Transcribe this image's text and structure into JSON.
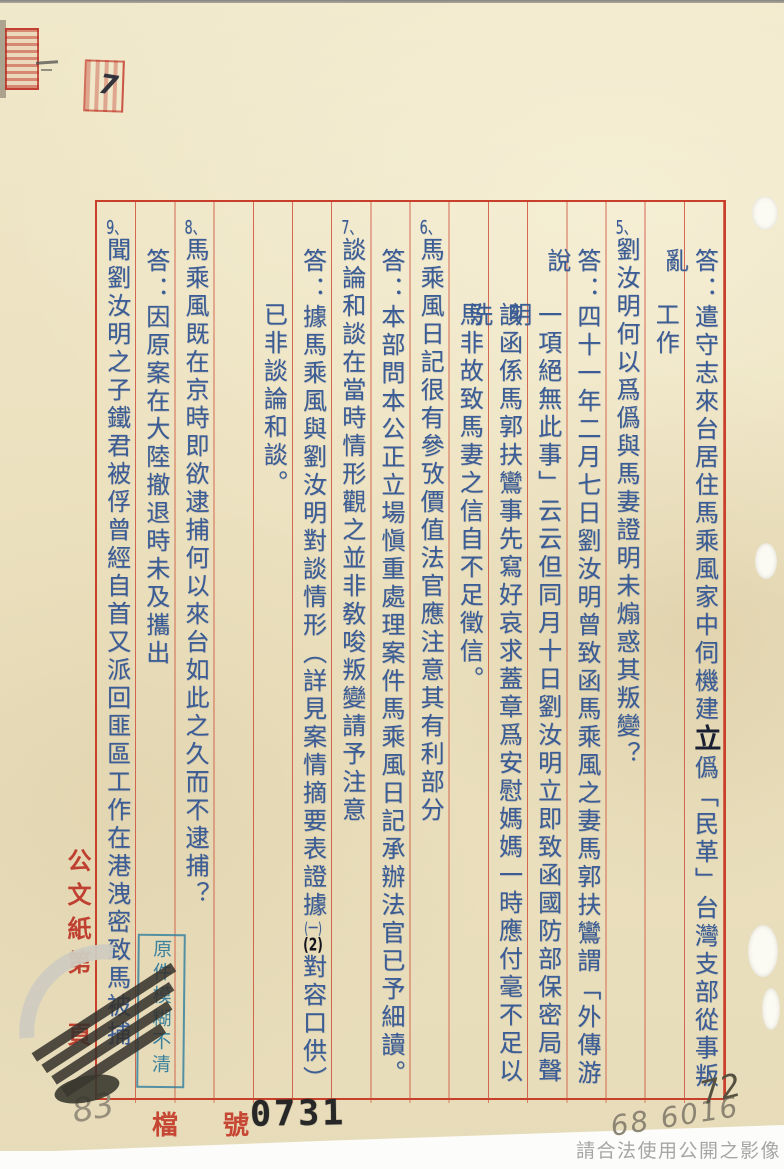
{
  "page": {
    "margin_label_top": "公文紙第",
    "margin_label_bottom": "頁",
    "file_label": "檔 號",
    "file_number": "0731",
    "handwritten_left": "83",
    "handwritten_right": "68 6016",
    "handwritten_ink": "72",
    "handwritten_mark": "7",
    "blue_stamp": "原件模糊不清",
    "usage_notice": "請合法使用公開之影像"
  },
  "colors": {
    "ink_blue": "#3b5c94",
    "frame_red": "#c8402c",
    "stamp_blue": "#2e7d9e",
    "seal_red": "#bb3a28"
  },
  "document": {
    "columns": [
      {
        "slot": 1,
        "indent": "answer",
        "segments": [
          {
            "t": "答：遣守志來台居住馬乘風家中伺機建",
            "k": "type"
          },
          {
            "t": "立",
            "k": "hand"
          },
          {
            "t": "僞「民革」台灣支部從事叛亂",
            "k": "type"
          }
        ]
      },
      {
        "slot": 2,
        "indent": "cont",
        "segments": [
          {
            "t": "工作",
            "k": "type"
          }
        ]
      },
      {
        "slot": 3,
        "indent": "item",
        "segments": [
          {
            "t": "5、",
            "k": "num"
          },
          {
            "t": "劉汝明何以爲僞與馬妻證明未煽惑其叛變？",
            "k": "type"
          }
        ]
      },
      {
        "slot": 4,
        "indent": "answer",
        "segments": [
          {
            "t": "答：四十一年二月七日劉汝明曾致函馬乘風之妻馬郭扶鸞謂「外傳游說",
            "k": "type"
          }
        ]
      },
      {
        "slot": 5,
        "indent": "cont",
        "segments": [
          {
            "t": "一項絕無此事」云云但同月十日劉汝明立即致函國防部保密局聲明",
            "k": "type"
          }
        ]
      },
      {
        "slot": 6,
        "indent": "cont",
        "segments": [
          {
            "t": "該函係馬郭扶鸞事先寫好哀求蓋章爲安慰媽媽一時應付毫不足以洗",
            "k": "type"
          }
        ]
      },
      {
        "slot": 7,
        "indent": "cont",
        "segments": [
          {
            "t": "馬非故致馬妻之信自不足徵信。",
            "k": "type"
          }
        ]
      },
      {
        "slot": 8,
        "indent": "item",
        "segments": [
          {
            "t": "6、",
            "k": "num"
          },
          {
            "t": "馬乘風日記很有參攷價值法官應注意其有利部分",
            "k": "type"
          }
        ]
      },
      {
        "slot": 9,
        "indent": "answer",
        "segments": [
          {
            "t": "答：本部問本公正立場愼重處理案件馬乘風日記承辦法官已予細讀。",
            "k": "type"
          }
        ]
      },
      {
        "slot": 10,
        "indent": "item",
        "segments": [
          {
            "t": "7、",
            "k": "num"
          },
          {
            "t": "談論和談在當時情形觀之並非敎唆叛變請予注意",
            "k": "type"
          }
        ]
      },
      {
        "slot": 11,
        "indent": "answer",
        "segments": [
          {
            "t": "答：據馬乘風與劉汝明對談情形（詳見案情摘要表證據",
            "k": "type"
          },
          {
            "t": "(一)",
            "k": "tcy"
          },
          {
            "t": "(2)",
            "k": "htcy"
          },
          {
            "t": "對容口供）",
            "k": "type"
          }
        ]
      },
      {
        "slot": 12,
        "indent": "cont",
        "segments": [
          {
            "t": "已非談論和談。",
            "k": "type"
          }
        ]
      },
      {
        "slot": 14,
        "indent": "item",
        "segments": [
          {
            "t": "8、",
            "k": "num"
          },
          {
            "t": "馬乘風既在京時即欲逮捕何以來台如此之久而不逮捕？",
            "k": "type"
          }
        ]
      },
      {
        "slot": 15,
        "indent": "answer",
        "segments": [
          {
            "t": "答：因原案在大陸撤退時未及攜出",
            "k": "type"
          }
        ]
      },
      {
        "slot": 16,
        "indent": "item",
        "segments": [
          {
            "t": "9、",
            "k": "num"
          },
          {
            "t": "聞劉汝明之子鐵君被俘曾經自首又派回匪區工作在港洩密致馬被捕",
            "k": "type"
          }
        ]
      }
    ]
  }
}
